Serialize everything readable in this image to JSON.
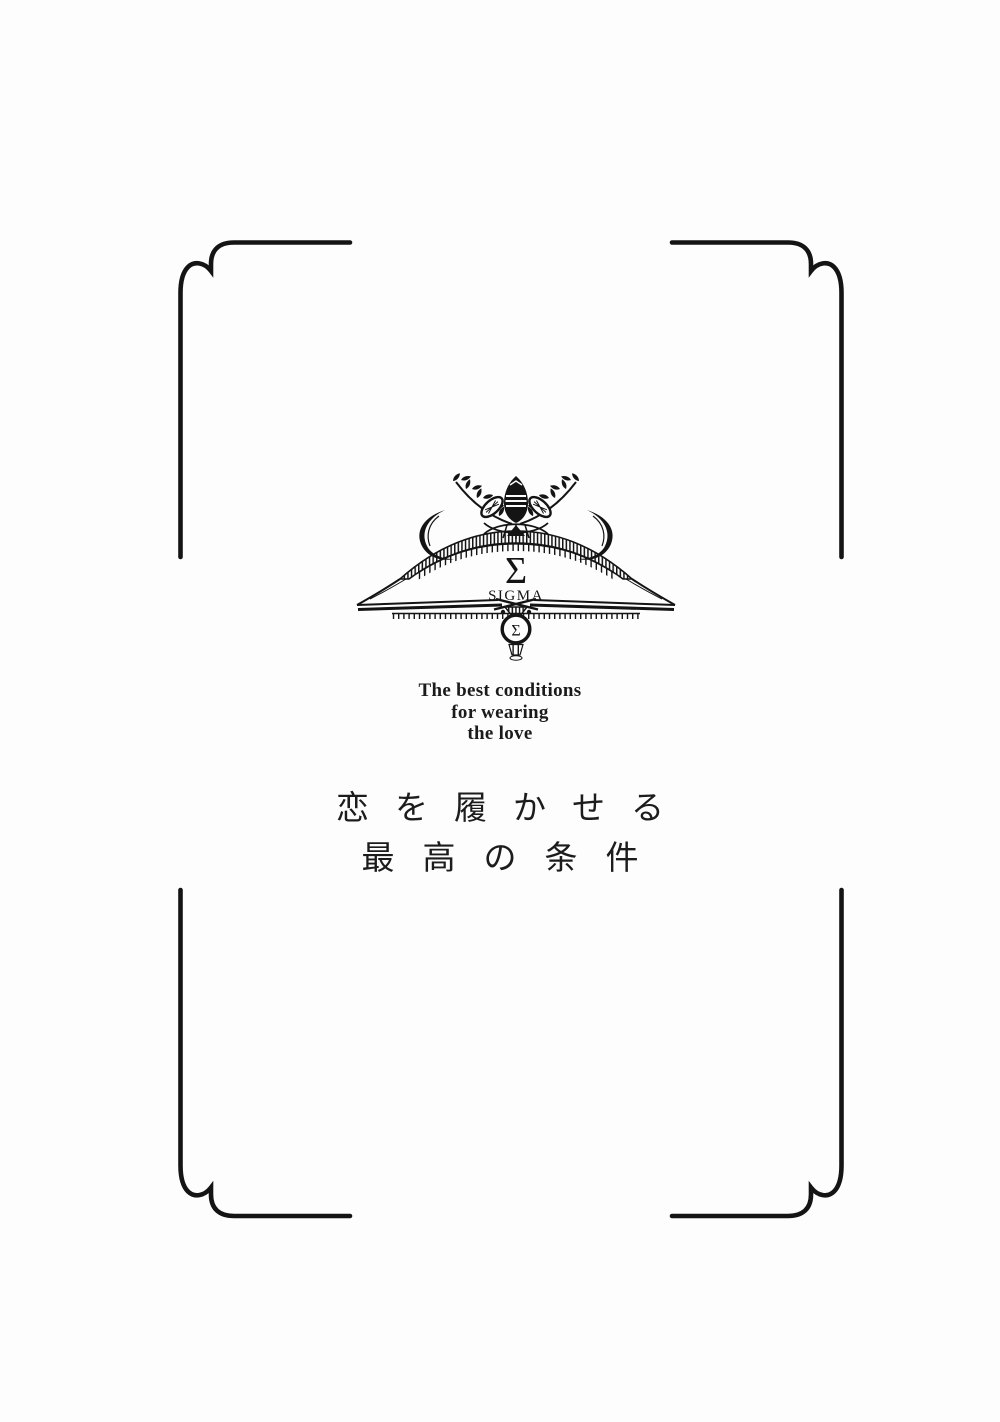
{
  "page": {
    "background": "#fdfdfd",
    "ink": "#141414"
  },
  "crest": {
    "large_sigma": "Σ",
    "brand_word": "SIGMA",
    "medallion_sigma": "Σ"
  },
  "english_subtitle": {
    "line1": "The best conditions",
    "line2": "for wearing",
    "line3": "the love"
  },
  "japanese_title": {
    "line1": "恋を履かせる",
    "line2": "最高の条件"
  }
}
